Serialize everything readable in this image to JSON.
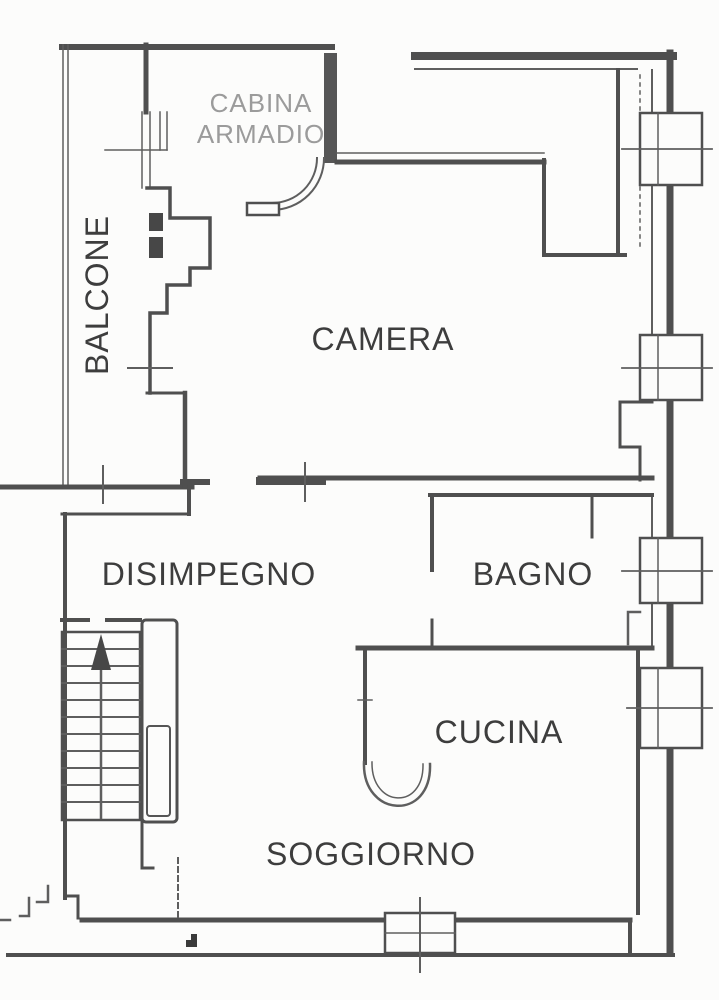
{
  "document": {
    "kind": "floor-plan",
    "language": "it"
  },
  "rooms": {
    "cabina_armadio": {
      "line1": "CABINA",
      "line2": "ARMADIO"
    },
    "balcone": {
      "label": "BALCONE"
    },
    "camera": {
      "label": "CAMERA"
    },
    "disimpegno": {
      "label": "DISIMPEGNO"
    },
    "bagno": {
      "label": "BAGNO"
    },
    "cucina": {
      "label": "CUCINA"
    },
    "soggiorno": {
      "label": "SOGGIORNO"
    }
  },
  "colors": {
    "wall": "#4f4f4f",
    "label": "#3d3d3d",
    "secondary_label": "#9b9b9b",
    "background": "#fcfcfb"
  }
}
